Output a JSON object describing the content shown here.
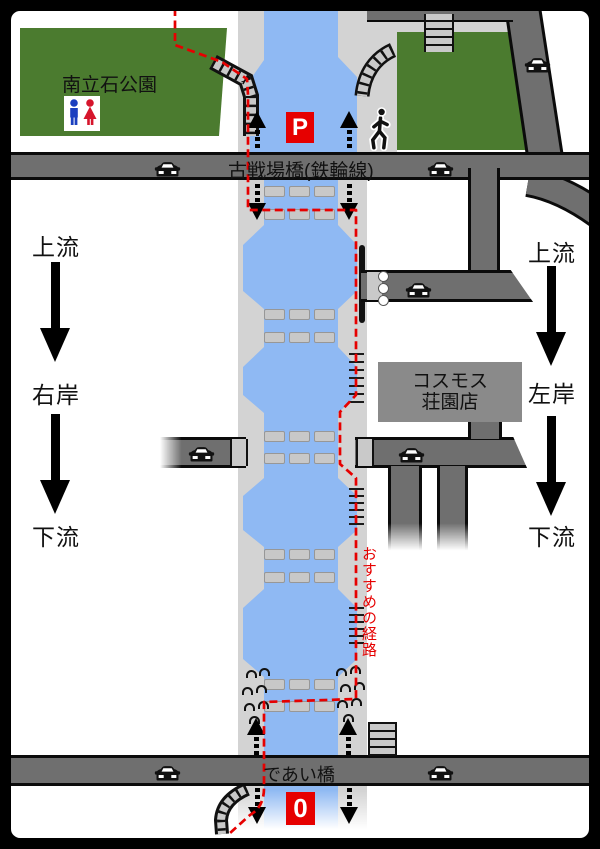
{
  "type": "riverside-guide-map",
  "labels": {
    "park_left": "南立石公園",
    "top_road": "古戦場橋(鉄輪線)",
    "bottom_road": "であい橋",
    "building": [
      "コスモス",
      "荘園店"
    ],
    "route": "おすすめの経路",
    "marker_parking": "P",
    "marker_start": "0",
    "left_column": {
      "upstream": "上流",
      "bank": "右岸",
      "downstream": "下流"
    },
    "right_column": {
      "upstream": "上流",
      "bank": "左岸",
      "downstream": "下流"
    }
  },
  "colors": {
    "park_green": "#4b7b2f",
    "grass_light_green": "#a9c29b",
    "river_blue": "#8fb9f3",
    "walkway_gray": "#d3d3d3",
    "road_gray": "#6f6f6f",
    "bridge_deck_gray": "#c9c9c9",
    "building_gray": "#8a8a8a",
    "route_red": "#e60000",
    "marker_red": "#e60000",
    "outline_black": "#111111"
  },
  "icons": {
    "car": "car-icon",
    "pedestrian": "pedestrian-icon",
    "restroom": "restroom-icon",
    "walkway_arrow": "walkway-direction-arrow",
    "flow_arrow": "flow-direction-arrow"
  }
}
